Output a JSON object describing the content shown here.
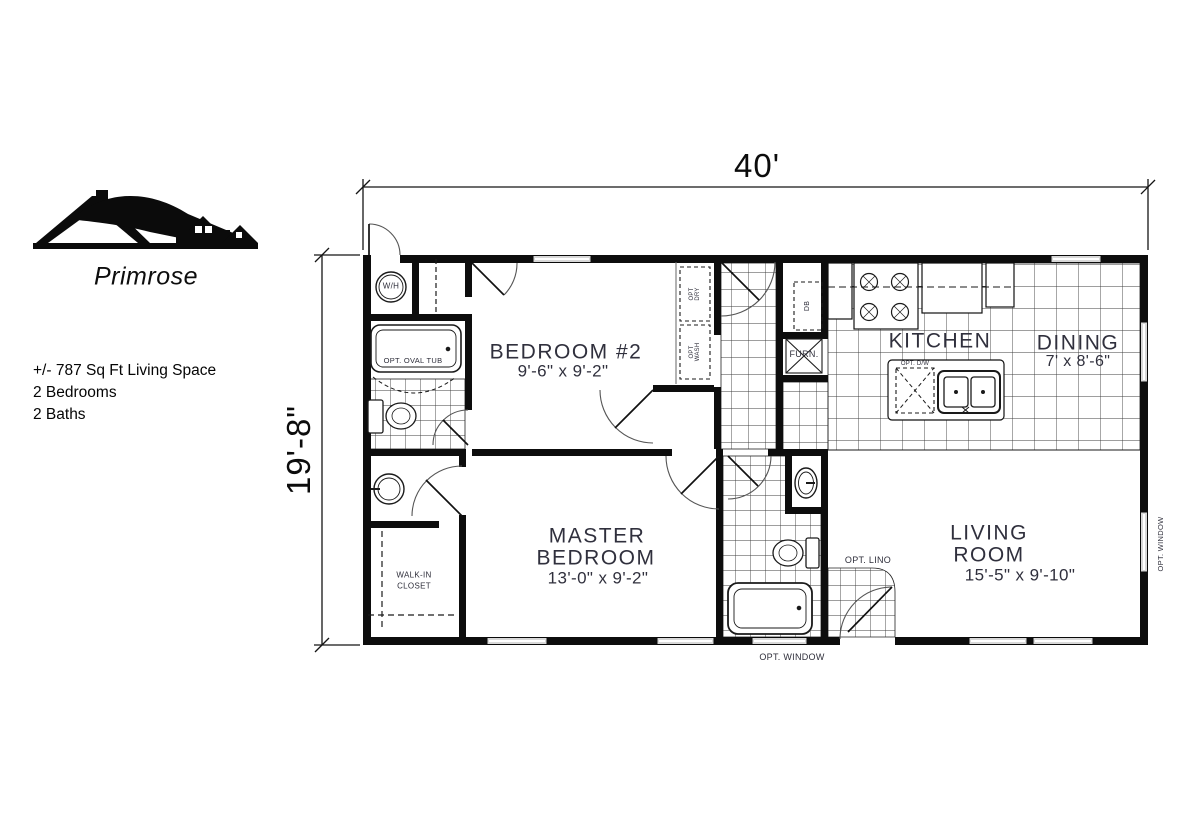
{
  "branding": {
    "model_name": "Primrose",
    "logo": "roofline-houses-logo"
  },
  "specs": {
    "living_space": "+/- 787 Sq Ft Living Space",
    "bedrooms": "2 Bedrooms",
    "baths": "2 Baths"
  },
  "dimensions": {
    "overall_width": "40'",
    "overall_depth": "19'-8\""
  },
  "rooms": {
    "bedroom2": {
      "name": "BEDROOM #2",
      "dims": "9'-6\" x 9'-2\""
    },
    "kitchen": {
      "name": "KITCHEN"
    },
    "dining": {
      "name": "DINING",
      "dims": "7' x 8'-6\""
    },
    "master": {
      "name_line1": "MASTER",
      "name_line2": "BEDROOM",
      "dims": "13'-0\" x 9'-2\""
    },
    "living": {
      "name_line1": "LIVING",
      "name_line2": "ROOM",
      "dims": "15'-5\" x 9'-10\""
    },
    "walk_in_closet": {
      "name_line1": "WALK-IN",
      "name_line2": "CLOSET"
    }
  },
  "fixtures": {
    "water_heater": "W/H",
    "opt_oval_tub": "OPT. OVAL TUB",
    "opt_dry_1": "OPT",
    "opt_dry_2": "DRY",
    "opt_wash_1": "OPT",
    "opt_wash_2": "WASH",
    "furnace": "FURN.",
    "drop_box": "DB",
    "opt_dishwasher": "OPT. D/W",
    "opt_lino": "OPT. LINO",
    "opt_window_bottom": "OPT. WINDOW",
    "opt_window_right": "OPT. WINDOW"
  }
}
